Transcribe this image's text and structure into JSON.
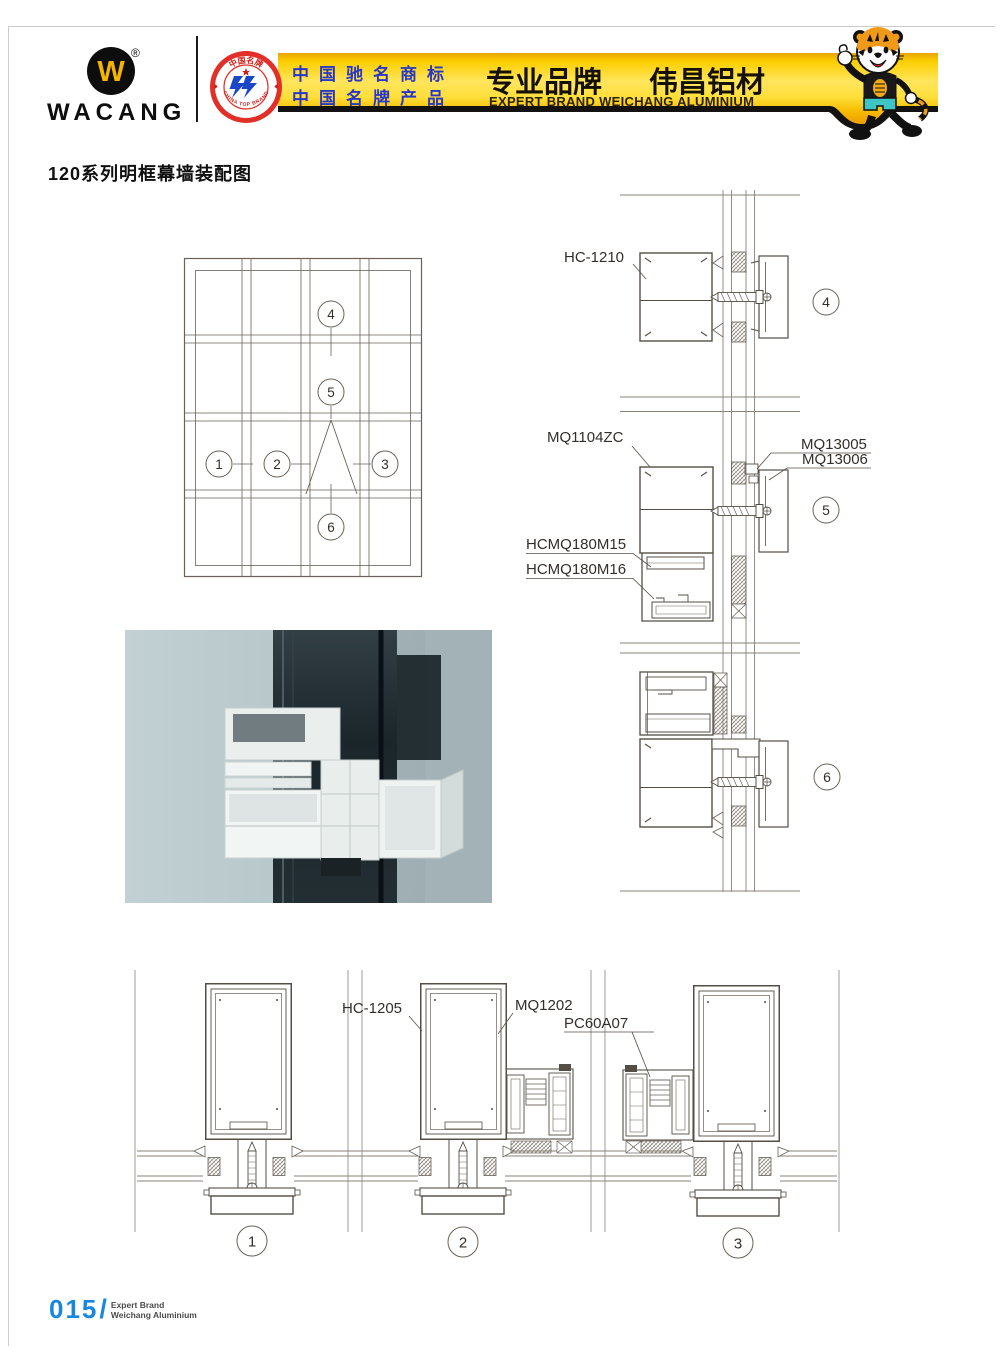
{
  "header": {
    "logo": {
      "letter": "W",
      "registered": "®",
      "brand": "WACANG"
    },
    "badge": {
      "arc_top": "中国名牌",
      "arc_bottom": "CHINA TOP BRAND"
    },
    "banner": {
      "cn_line1": "中国驰名商标",
      "cn_line2": "中国名牌产品",
      "slogan_left": "专业品牌",
      "slogan_right": "伟昌铝材",
      "slogan_en": "EXPERT BRAND WEICHANG ALUMINIUM"
    }
  },
  "page_title": "120系列明框幕墙装配图",
  "callouts": {
    "c1": "1",
    "c2": "2",
    "c3": "3",
    "c4": "4",
    "c5": "5",
    "c6": "6"
  },
  "part_labels": {
    "hc1210": "HC-1210",
    "mq1104zc": "MQ1104ZC",
    "mq13005": "MQ13005",
    "mq13006": "MQ13006",
    "hcmq180m15": "HCMQ180M15",
    "hcmq180m16": "HCMQ180M16",
    "hc1205": "HC-1205",
    "mq1202": "MQ1202",
    "pc60a07": "PC60A07"
  },
  "footer": {
    "page_number": "015",
    "separator": "/",
    "line1": "Expert Brand",
    "line2": "Weichang Aluminium"
  },
  "colors": {
    "banner_yellow": "#FFE55E",
    "banner_deep": "#ED9C00",
    "strip_black": "#141210",
    "blue_text": "#2937C6",
    "page_blue": "#1787E0",
    "drawing_line": "#5F574D"
  }
}
